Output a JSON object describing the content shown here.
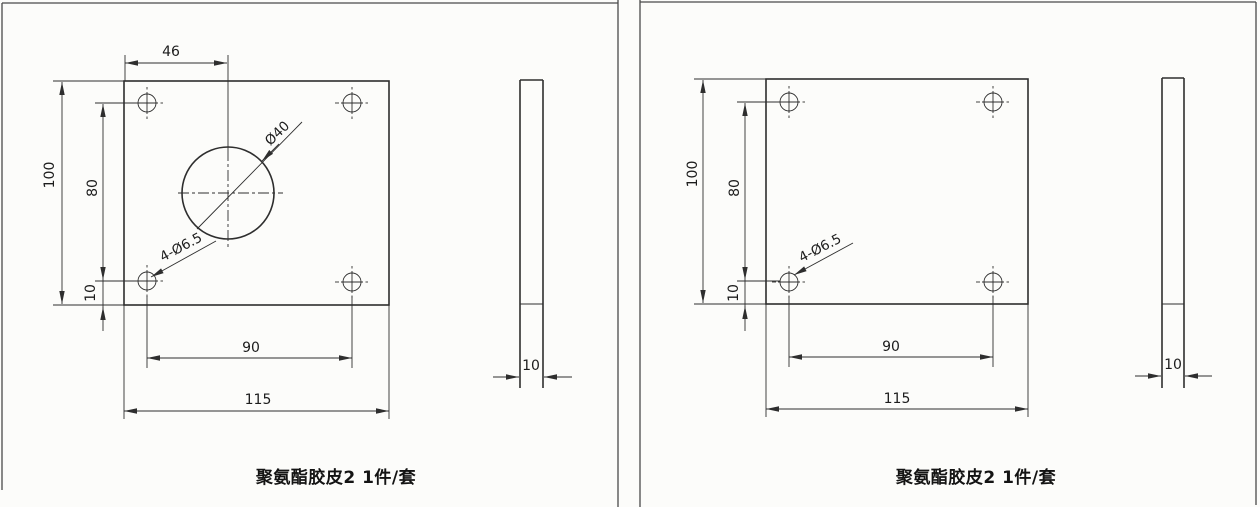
{
  "colors": {
    "background": "#fcfcfa",
    "line": "#2e2e2e",
    "text": "#1c1c1c"
  },
  "sheets": {
    "left": {
      "caption": "聚氨酯胶皮2 1件/套",
      "front": {
        "dim_circle_offset": "46",
        "dim_height": "100",
        "dim_hole_vspan": "80",
        "dim_edge_gap": "10",
        "dim_hole_span": "90",
        "dim_width": "115",
        "label_center_hole": "Ø40",
        "label_corner_holes": "4-Ø6.5"
      },
      "side": {
        "dim_thickness": "10"
      }
    },
    "right": {
      "caption": "聚氨酯胶皮2 1件/套",
      "front": {
        "dim_height": "100",
        "dim_hole_vspan": "80",
        "dim_edge_gap": "10",
        "dim_hole_span": "90",
        "dim_width": "115",
        "label_corner_holes": "4-Ø6.5"
      },
      "side": {
        "dim_thickness": "10"
      }
    }
  }
}
